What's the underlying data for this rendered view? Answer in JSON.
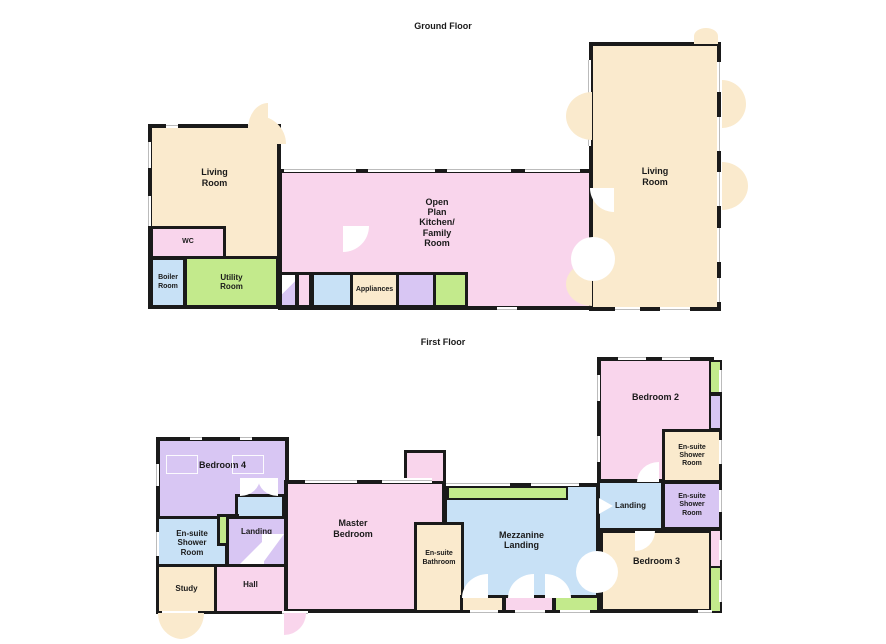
{
  "titles": {
    "ground": "Ground Floor",
    "first": "First Floor"
  },
  "palette": {
    "room_cream": "#FAEACD",
    "room_pink": "#F9D5EC",
    "room_blue": "#C8E1F6",
    "room_green": "#C3EA8C",
    "room_purple": "#D8C6F3",
    "wall": "#1A1A1A",
    "background": "#FFFFFF"
  },
  "ground": {
    "living_room_left": "Living\nRoom",
    "wc": "WC",
    "boiler_room": "Boiler\nRoom",
    "utility_room": "Utility\nRoom",
    "open_plan": "Open\nPlan\nKitchen/\nFamily\nRoom",
    "appliances": "Appliances",
    "living_room_right": "Living\nRoom"
  },
  "first": {
    "bedroom_4": "Bedroom 4",
    "ensuite_shower_left": "En-suite\nShower\nRoom",
    "landing_left": "Landing",
    "study": "Study",
    "hall": "Hall",
    "master_bedroom": "Master\nBedroom",
    "ensuite_bathroom": "En-suite\nBathroom",
    "mezzanine_landing": "Mezzanine\nLanding",
    "landing_right": "Landing",
    "bedroom_2": "Bedroom 2",
    "ensuite_shower_top_right": "En-suite\nShower\nRoom",
    "ensuite_shower_right": "En-suite\nShower\nRoom",
    "bedroom_3": "Bedroom 3"
  }
}
